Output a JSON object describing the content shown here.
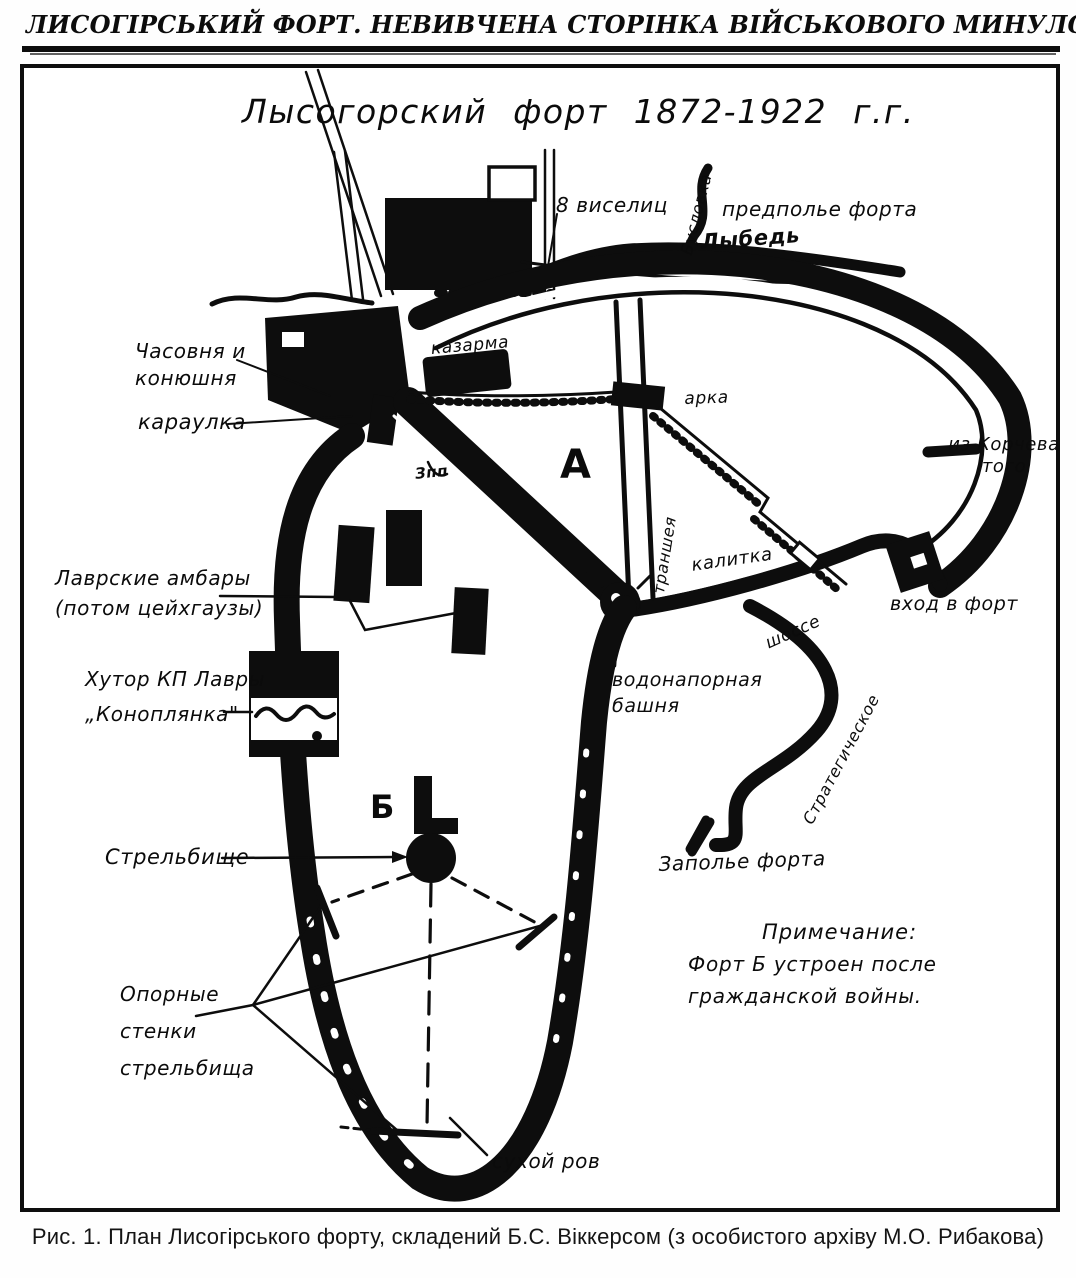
{
  "colors": {
    "ink": "#0d0d0d",
    "paper": "#ffffff"
  },
  "header": {
    "title": "ЛИСОГІРСЬКИЙ ФОРТ. НЕВИВЧЕНА СТОРІНКА ВІЙСЬКОВОГО МИНУЛОГО КИЄВА",
    "page_number": "17"
  },
  "map": {
    "title": "Лысогорский  форт  1872-1922 г.г.",
    "labels": {
      "gallows": "8 виселиц",
      "forefield": "предполье форта",
      "buslovka": "Бусловка",
      "lybid": "Лыбедь",
      "chapel": "Часовня и\nконюшня",
      "guardhouse": "караулка",
      "barracks": "казарма",
      "arch": "арка",
      "sector_a": "А",
      "zpp": "Зпп",
      "trench": "траншея",
      "wicket": "калитка",
      "from_korchevatoe": "из Корчева\nтого",
      "fort_entrance": "вход в форт",
      "water_tower": "водонапорная\nбашня",
      "highway": "шоссе",
      "strategic": "Стратегическое",
      "lavra_barns": "Лаврские амбары\n(потом цейхгаузы)",
      "farmstead": "Хутор  КП Лавры\n„Коноплянка\"",
      "sector_b": "Б",
      "shooting_range": "Стрельбище",
      "support_walls": "Опорные\nстенки\nстрельбища",
      "dry_moat": "сухой  ров",
      "rear_field": "Заполье  форта"
    },
    "note": {
      "title": "Примечание:",
      "body": "Форт Б  устроен после\nгражданской войны."
    }
  },
  "caption": "Рис. 1. План Лисогірського форту, складений Б.С. Віккерсом (з особистого архіву М.О. Рибакова)"
}
